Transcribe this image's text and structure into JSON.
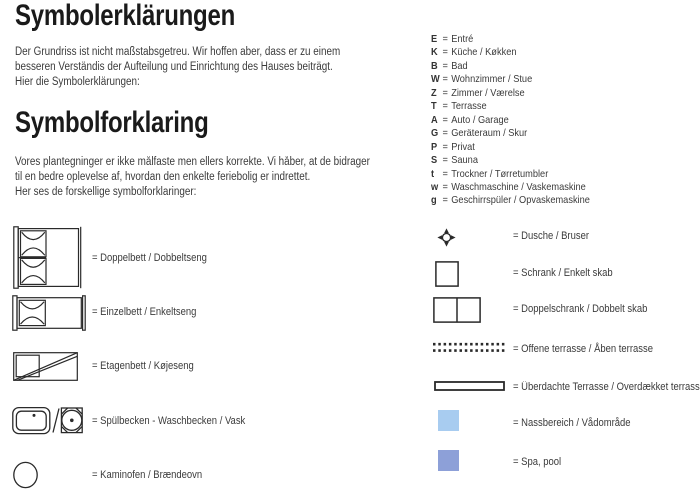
{
  "eq": "=",
  "colors": {
    "line": "#2a2a2a",
    "text": "#3b3b3b",
    "wet_area": "#a8ccf0",
    "spa_pool": "#8da0d8"
  },
  "german": {
    "title": "Symbolerklärungen",
    "lines": [
      "Der Grundriss ist nicht maßstabsgetreu. Wir hoffen aber, dass er zu einem",
      "besseren Verständis der Aufteilung und Einrichtung des Hauses beiträgt.",
      "Hier die Symbolerklärungen:"
    ]
  },
  "danish": {
    "title": "Symbolforklaring",
    "lines": [
      "Vores plantegninger er ikke målfaste men ellers korrekte. Vi håber, at de bidrager",
      "til en bedre oplevelse af, hvordan den enkelte feriebolig er indrettet.",
      "Her ses de forskellige symbolforklaringer:"
    ]
  },
  "room_codes": [
    {
      "key": "E",
      "label": "Entré"
    },
    {
      "key": "K",
      "label": "Küche / Køkken"
    },
    {
      "key": "B",
      "label": "Bad"
    },
    {
      "key": "W",
      "label": "Wohnzimmer / Stue"
    },
    {
      "key": "Z",
      "label": "Zimmer / Værelse"
    },
    {
      "key": "T",
      "label": "Terrasse"
    },
    {
      "key": "A",
      "label": "Auto / Garage"
    },
    {
      "key": "G",
      "label": "Geräteraum / Skur"
    },
    {
      "key": "P",
      "label": "Privat"
    },
    {
      "key": "S",
      "label": "Sauna"
    },
    {
      "key": "t",
      "label": "Trockner / Tørretumbler"
    },
    {
      "key": "w",
      "label": "Waschmaschine / Vaskemaskine"
    },
    {
      "key": "g",
      "label": "Geschirrspüler / Opvaskemaskine"
    }
  ],
  "left_legend": [
    {
      "icon": "double-bed",
      "label": "= Doppelbett / Dobbeltseng"
    },
    {
      "icon": "single-bed",
      "label": "= Einzelbett / Enkeltseng"
    },
    {
      "icon": "bunk-bed",
      "label": "= Etagenbett / Køjeseng"
    },
    {
      "icon": "sink-washbasin",
      "label": "= Spülbecken - Waschbecken / Vask"
    },
    {
      "icon": "wood-stove",
      "label": "= Kaminofen / Brændeovn"
    }
  ],
  "right_legend": [
    {
      "icon": "shower",
      "label": "= Dusche / Bruser"
    },
    {
      "icon": "cabinet",
      "label": "= Schrank / Enkelt skab"
    },
    {
      "icon": "double-cabinet",
      "label": "= Doppelschrank / Dobbelt skab"
    },
    {
      "icon": "open-terrace",
      "label": "= Offene terrasse / Åben terrasse"
    },
    {
      "icon": "covered-terrace",
      "label": "= Überdachte Terrasse / Overdækket terrasse"
    },
    {
      "icon": "wet-area",
      "label": "= Nassbereich / Vådområde"
    },
    {
      "icon": "spa-pool",
      "label": "= Spa, pool"
    }
  ]
}
